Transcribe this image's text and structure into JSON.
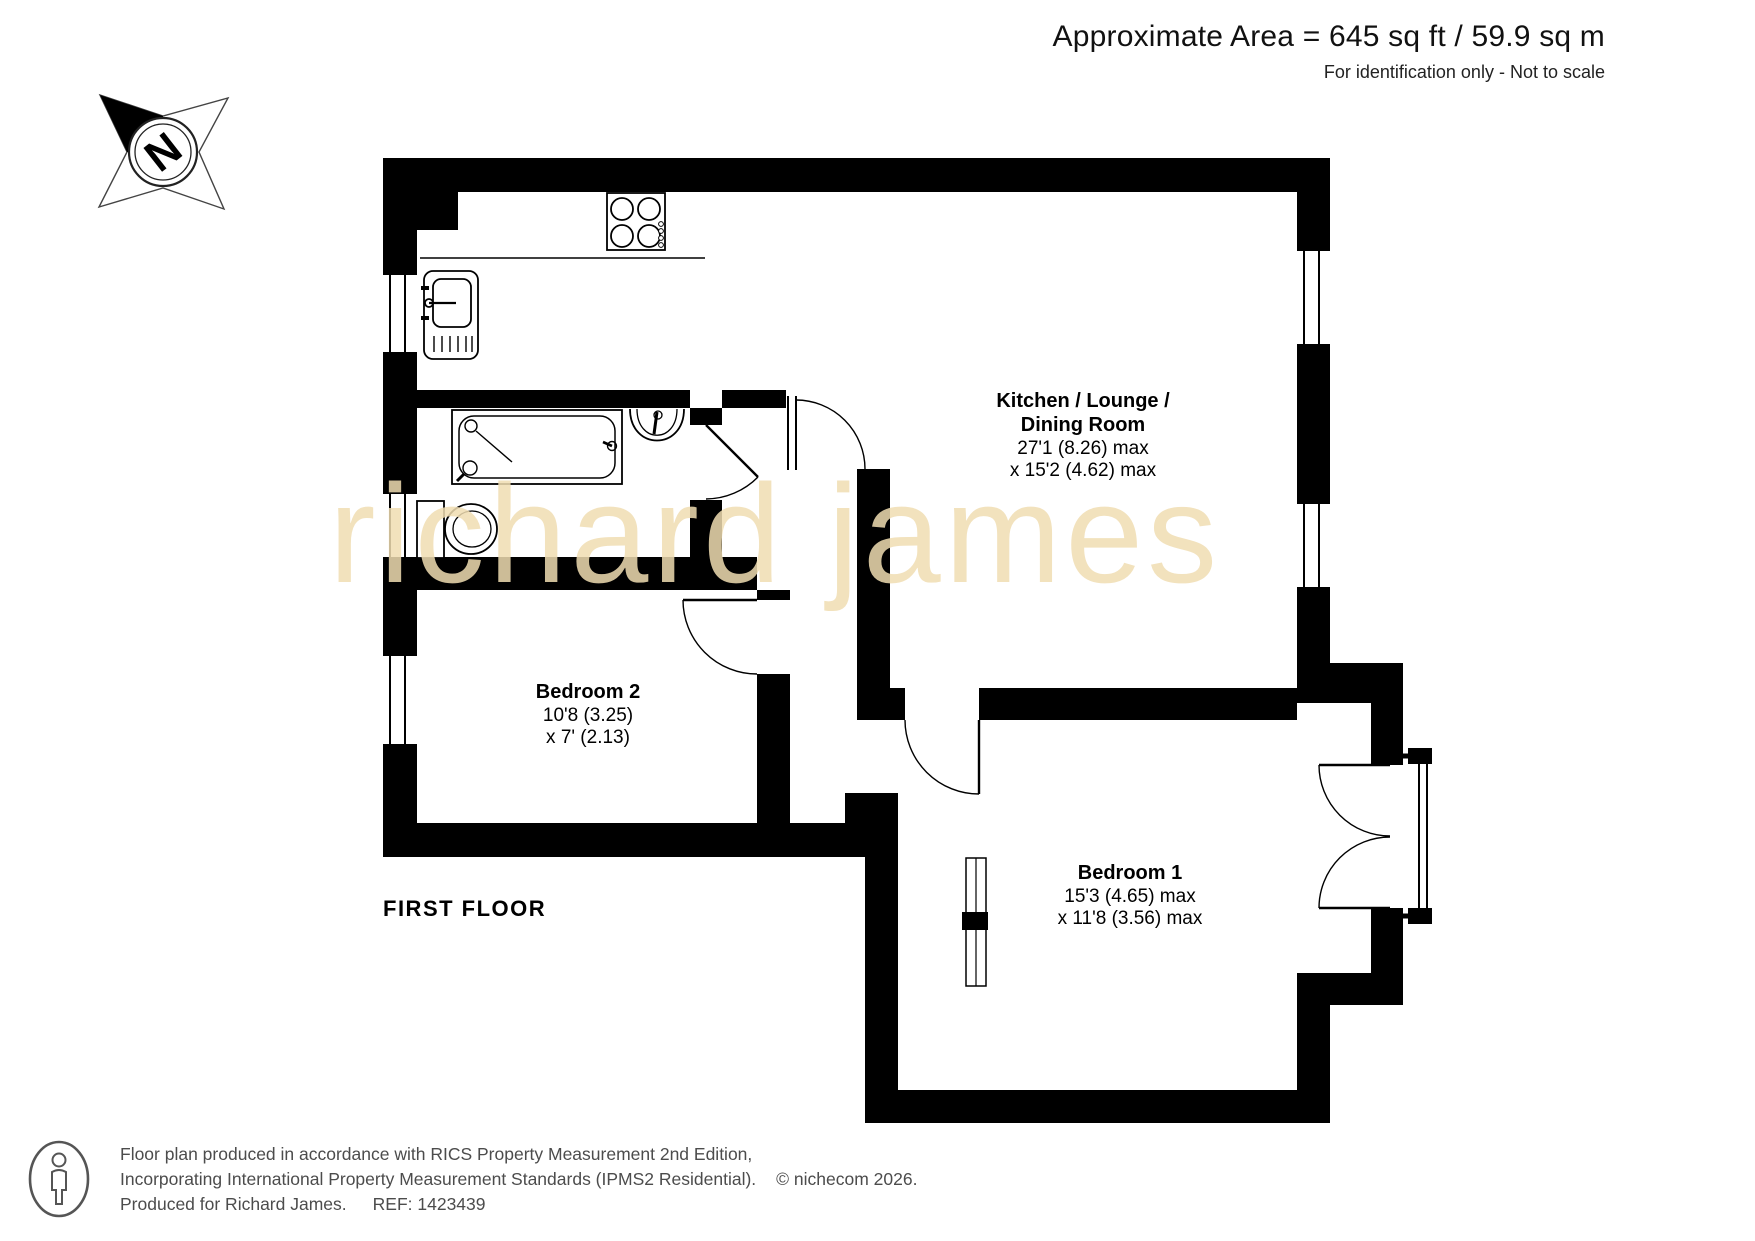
{
  "header": {
    "area": "Approximate Area = 645 sq ft / 59.9 sq m",
    "note": "For identification only - Not to scale"
  },
  "compass": {
    "letter": "N"
  },
  "watermark": {
    "text": "richard james"
  },
  "floor": {
    "label": "FIRST FLOOR"
  },
  "rooms": {
    "kitchen": {
      "name_line1": "Kitchen / Lounge /",
      "name_line2": "Dining Room",
      "dim_line1": "27'1 (8.26) max",
      "dim_line2": "x 15'2 (4.62) max"
    },
    "bedroom2": {
      "name": "Bedroom 2",
      "dim_line1": "10'8 (3.25)",
      "dim_line2": "x 7' (2.13)"
    },
    "bedroom1": {
      "name": "Bedroom 1",
      "dim_line1": "15'3 (4.65) max",
      "dim_line2": "x 11'8 (3.56) max"
    }
  },
  "footer": {
    "line1": "Floor plan produced in accordance with RICS Property Measurement 2nd Edition,",
    "line2": "Incorporating International Property Measurement Standards (IPMS2 Residential).",
    "copyright": "© nichecom 2026.",
    "produced_for": "Produced for Richard James.",
    "ref": "REF:  1423439"
  },
  "icons": {
    "compass": "north-compass-rose",
    "hob": "cooker-hob",
    "kitchen_sink": "kitchen-sink-drainer",
    "bath": "bath-with-shower",
    "basin": "wash-basin",
    "toilet": "toilet",
    "wardrobe": "built-in-cupboard",
    "person": "person-logo"
  },
  "colors": {
    "wall": "#000000",
    "watermark": "#F0DDB2",
    "footer_text": "#4C4C4C"
  }
}
